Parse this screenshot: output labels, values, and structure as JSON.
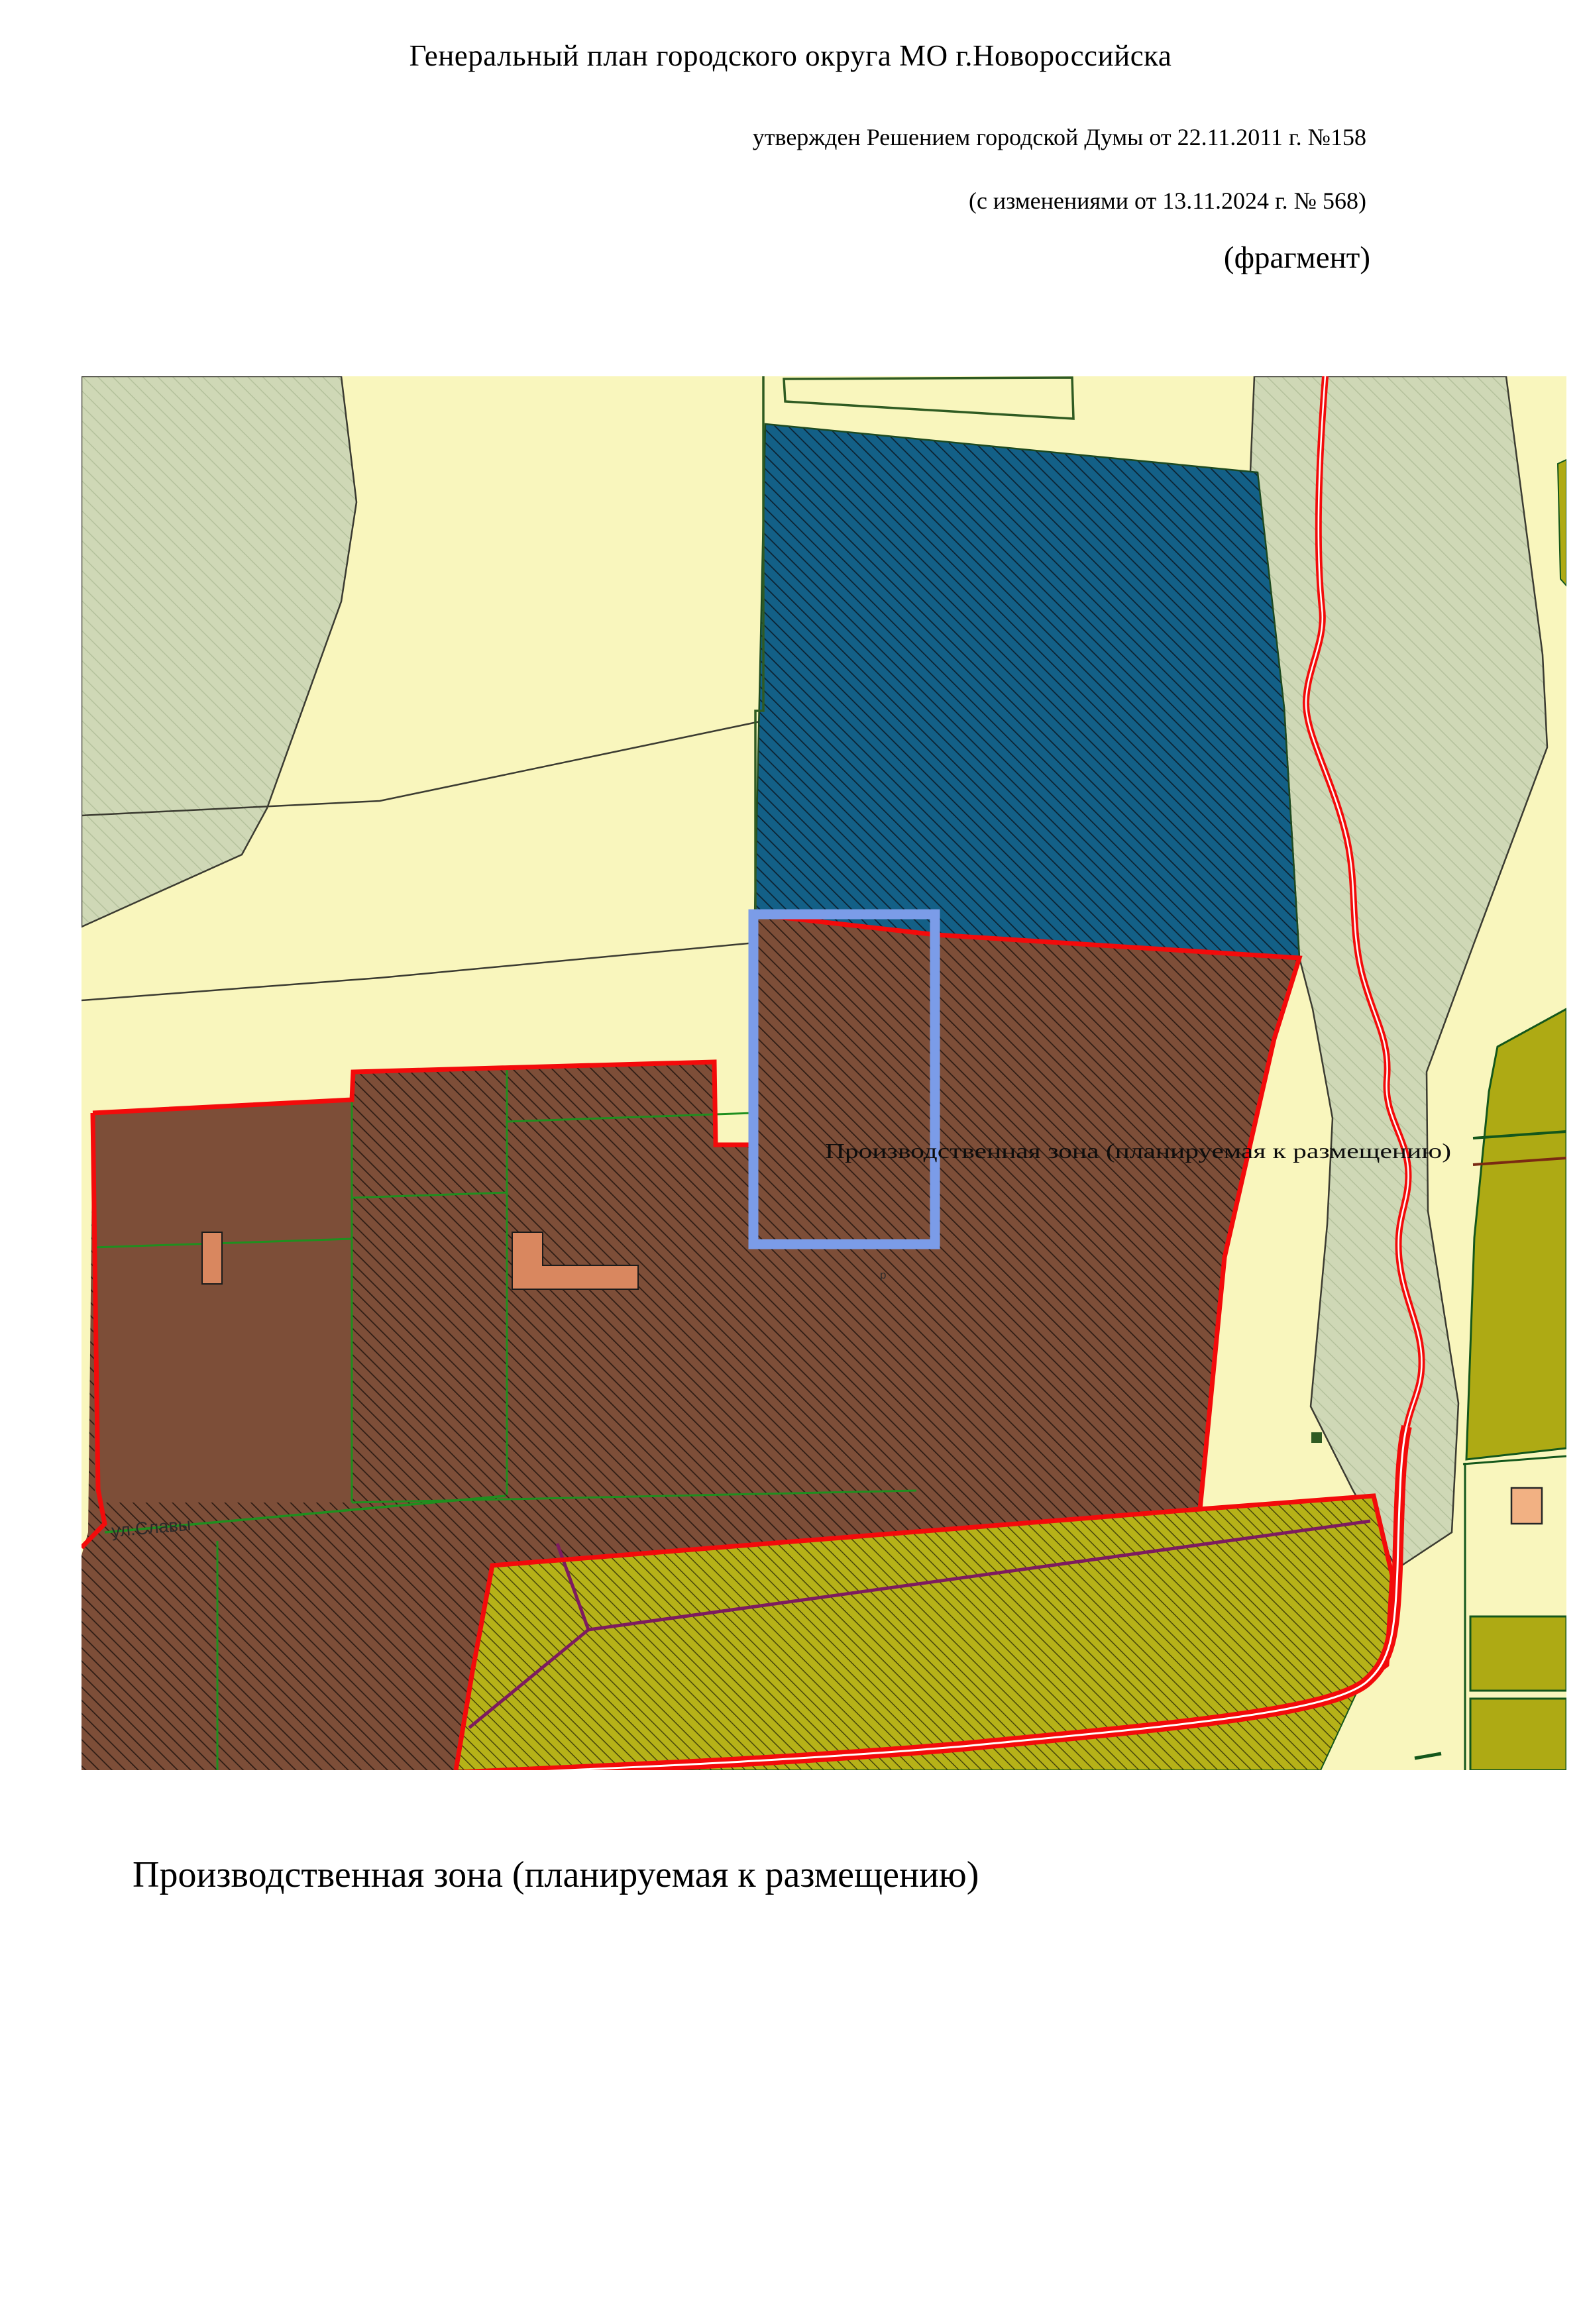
{
  "header": {
    "title": "Генеральный план городского округа МО г.Новороссийска",
    "approval_line": "утвержден Решением городской Думы от 22.11.2011 г. №158",
    "amendment_line": "(с изменениями от 13.11.2024 г. № 568)",
    "fragment_label": "(фрагмент)"
  },
  "map": {
    "overlay_label": "Производственная зона (планируемая к размещению)",
    "street_label": "ул.Славы",
    "parcel_mark": "р",
    "colors": {
      "pale_yellow_background": "#f9f6bd",
      "sage_hatched_zone": "#cfd8b6",
      "sage_hatch_line": "#b4c19c",
      "teal_hatched_zone": "#136087",
      "brown_hatched_zone": "#7d4e38",
      "olive_hatched_zone": "#b6b218",
      "olive_solid_zone": "#aeaa14",
      "red_zone_boundary": "#f30b0b",
      "red_road": "#f30b0b",
      "green_parcel_line": "#1f8f1f",
      "dark_green_border": "#14571b",
      "highlight_parcel_blue": "#7b9ce8",
      "purple_line": "#7d1b5f",
      "salmon_building": "#d9875f"
    }
  },
  "caption": "Производственная зона (планируемая к размещению)"
}
